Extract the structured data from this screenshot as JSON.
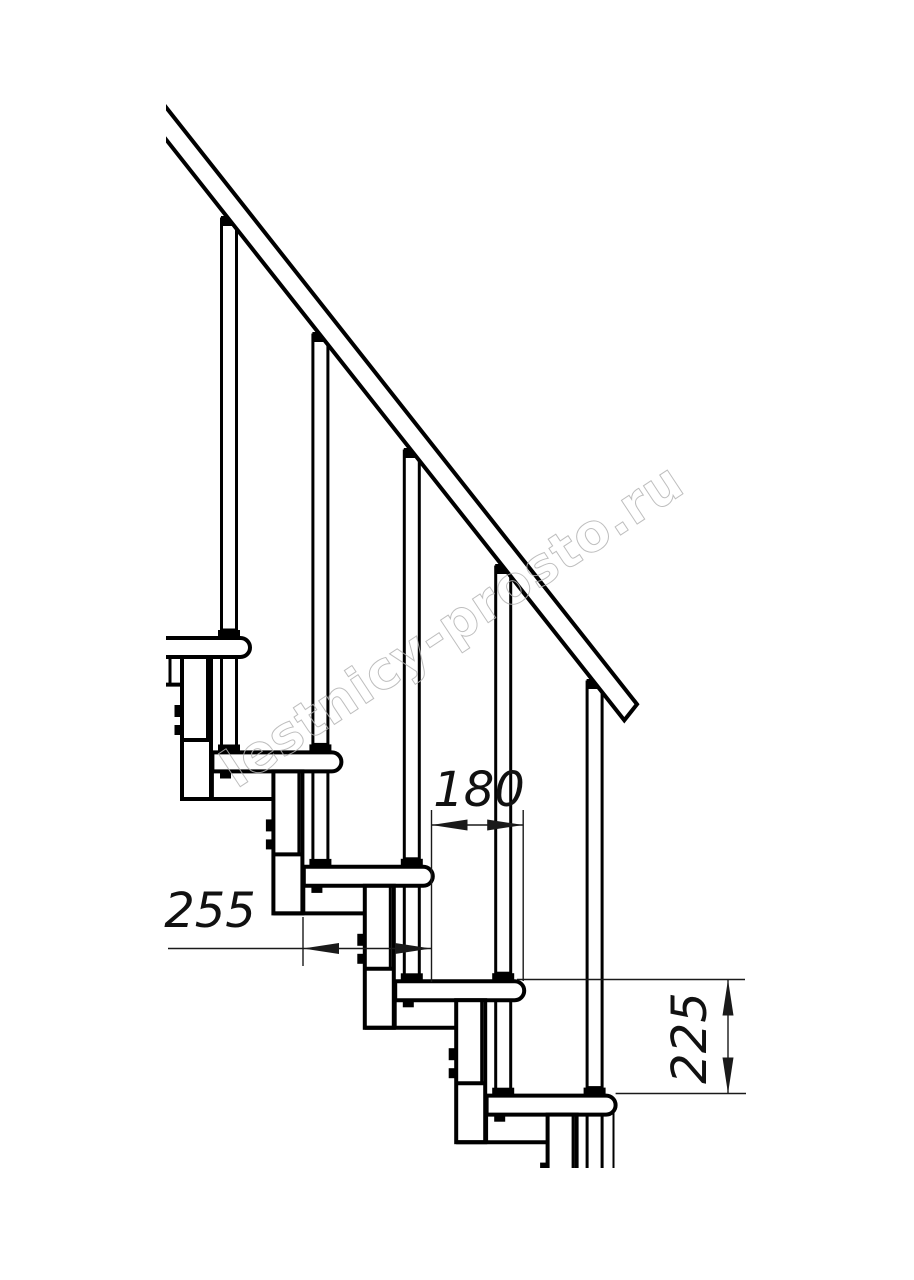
{
  "drawing": {
    "title": "modular-staircase-side-elevation",
    "colors": {
      "line": "#000000",
      "background": "#ffffff",
      "watermark": "#b3b3b3"
    },
    "watermark": {
      "text": "lestnicy-prosto.ru"
    },
    "dimensions": {
      "run": {
        "value": "180"
      },
      "depth": {
        "value": "255"
      },
      "rise": {
        "value": "225"
      }
    }
  }
}
